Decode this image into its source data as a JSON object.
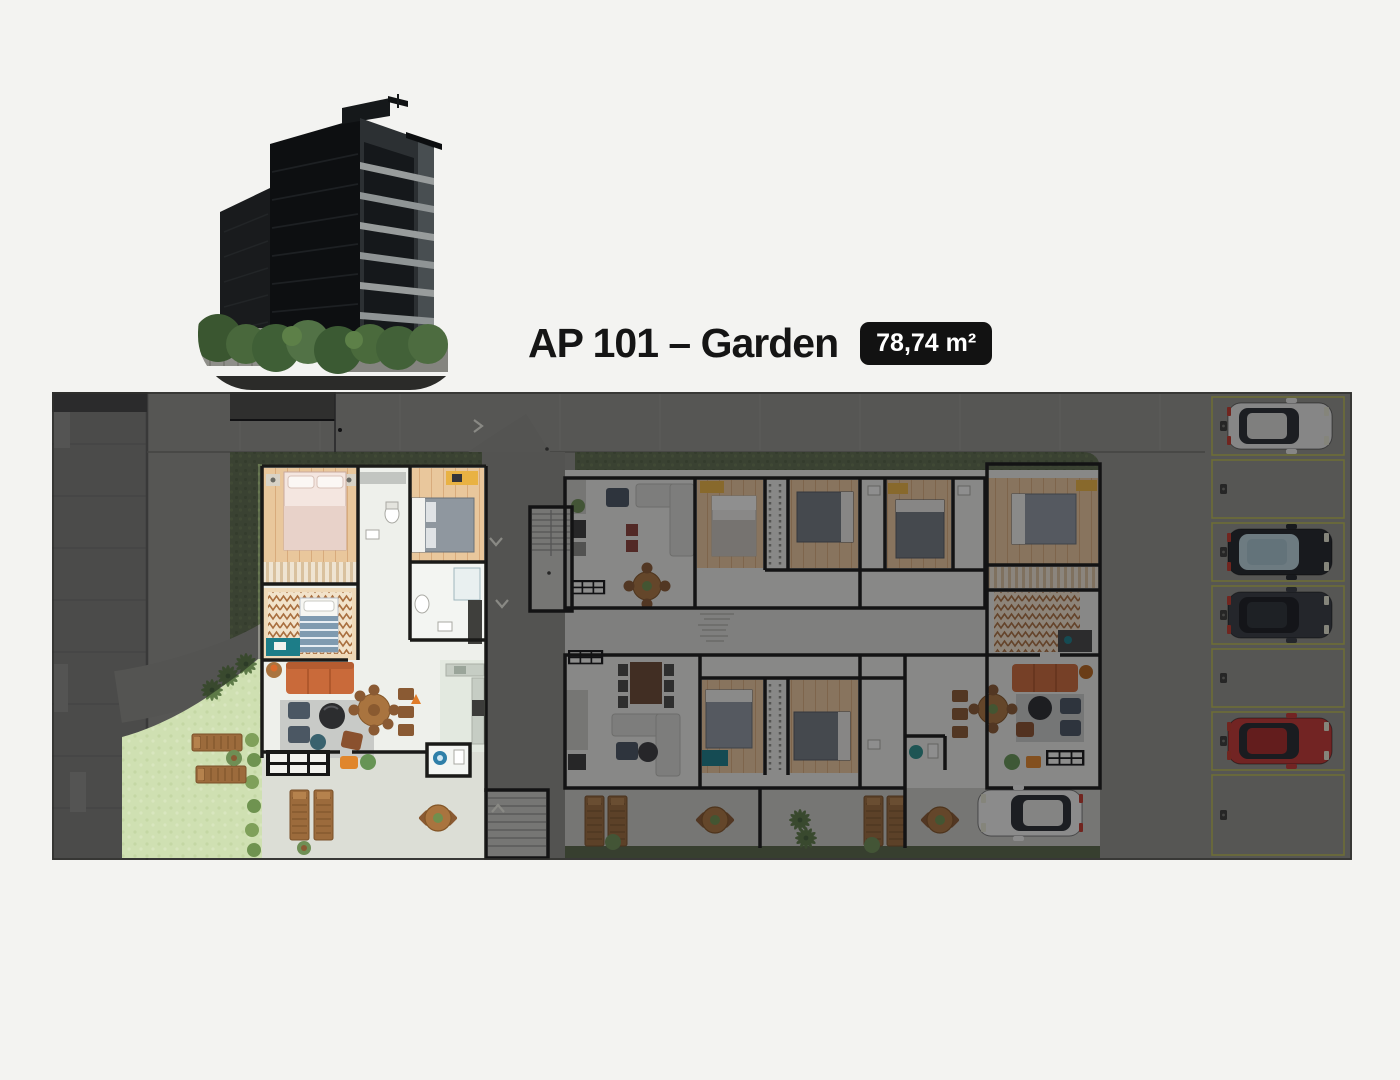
{
  "header": {
    "title": "AP 101 – Garden",
    "area_badge": "78,74 m²",
    "badge_bg": "#121212",
    "badge_text_color": "#ffffff"
  },
  "building_image": {
    "name": "building-exterior-render",
    "description": "dark multi-story residential building with trees, rounded-blob crop"
  },
  "floor_plan": {
    "name": "ground-floor-site-plan",
    "highlighted_unit": "AP 101 – Garden",
    "highlighted_area": "78,74 m²",
    "colors": {
      "dim_overlay": "rgba(12,12,16,0.44)",
      "asphalt": "#90908a",
      "sidewalk": "#7d7d78",
      "hedge": "#5f6d4d",
      "lawn": "#cfe0b2",
      "wood_floor": "#e9c79c",
      "interior_floor": "#eef0eb",
      "wall": "#1a1a18",
      "patio": "#dcded6",
      "stall_line": "#b9b955",
      "sofa_accent": "#c96a3a",
      "desk_teal": "#1d7d88",
      "wardrobe_yellow": "#e9b243"
    },
    "parking": {
      "stall_count": 7,
      "stalls": [
        {
          "index": 1,
          "car": {
            "type": "silver-hatchback",
            "body": "#e7e7e3",
            "glass": "#2a2d31",
            "roof": "#d9d9d5"
          }
        },
        {
          "index": 2,
          "car": null
        },
        {
          "index": 3,
          "car": {
            "type": "dark-sedan-blue-glass",
            "body": "#23262a",
            "glass": "#b9d2da",
            "roof": "#a8c4cd"
          }
        },
        {
          "index": 4,
          "car": {
            "type": "dark-suv",
            "body": "#383c40",
            "glass": "#1b1e21",
            "roof": "#2e3236"
          }
        },
        {
          "index": 5,
          "car": null
        },
        {
          "index": 6,
          "car": {
            "type": "red-sedan",
            "body": "#c23832",
            "glass": "#26292d",
            "roof": "#a82c28"
          }
        },
        {
          "index": 7,
          "car": null
        }
      ]
    },
    "street_car": {
      "type": "white-hatchback",
      "body": "#efefeb",
      "glass": "#2a2d31",
      "roof": "#e2e2de"
    }
  }
}
